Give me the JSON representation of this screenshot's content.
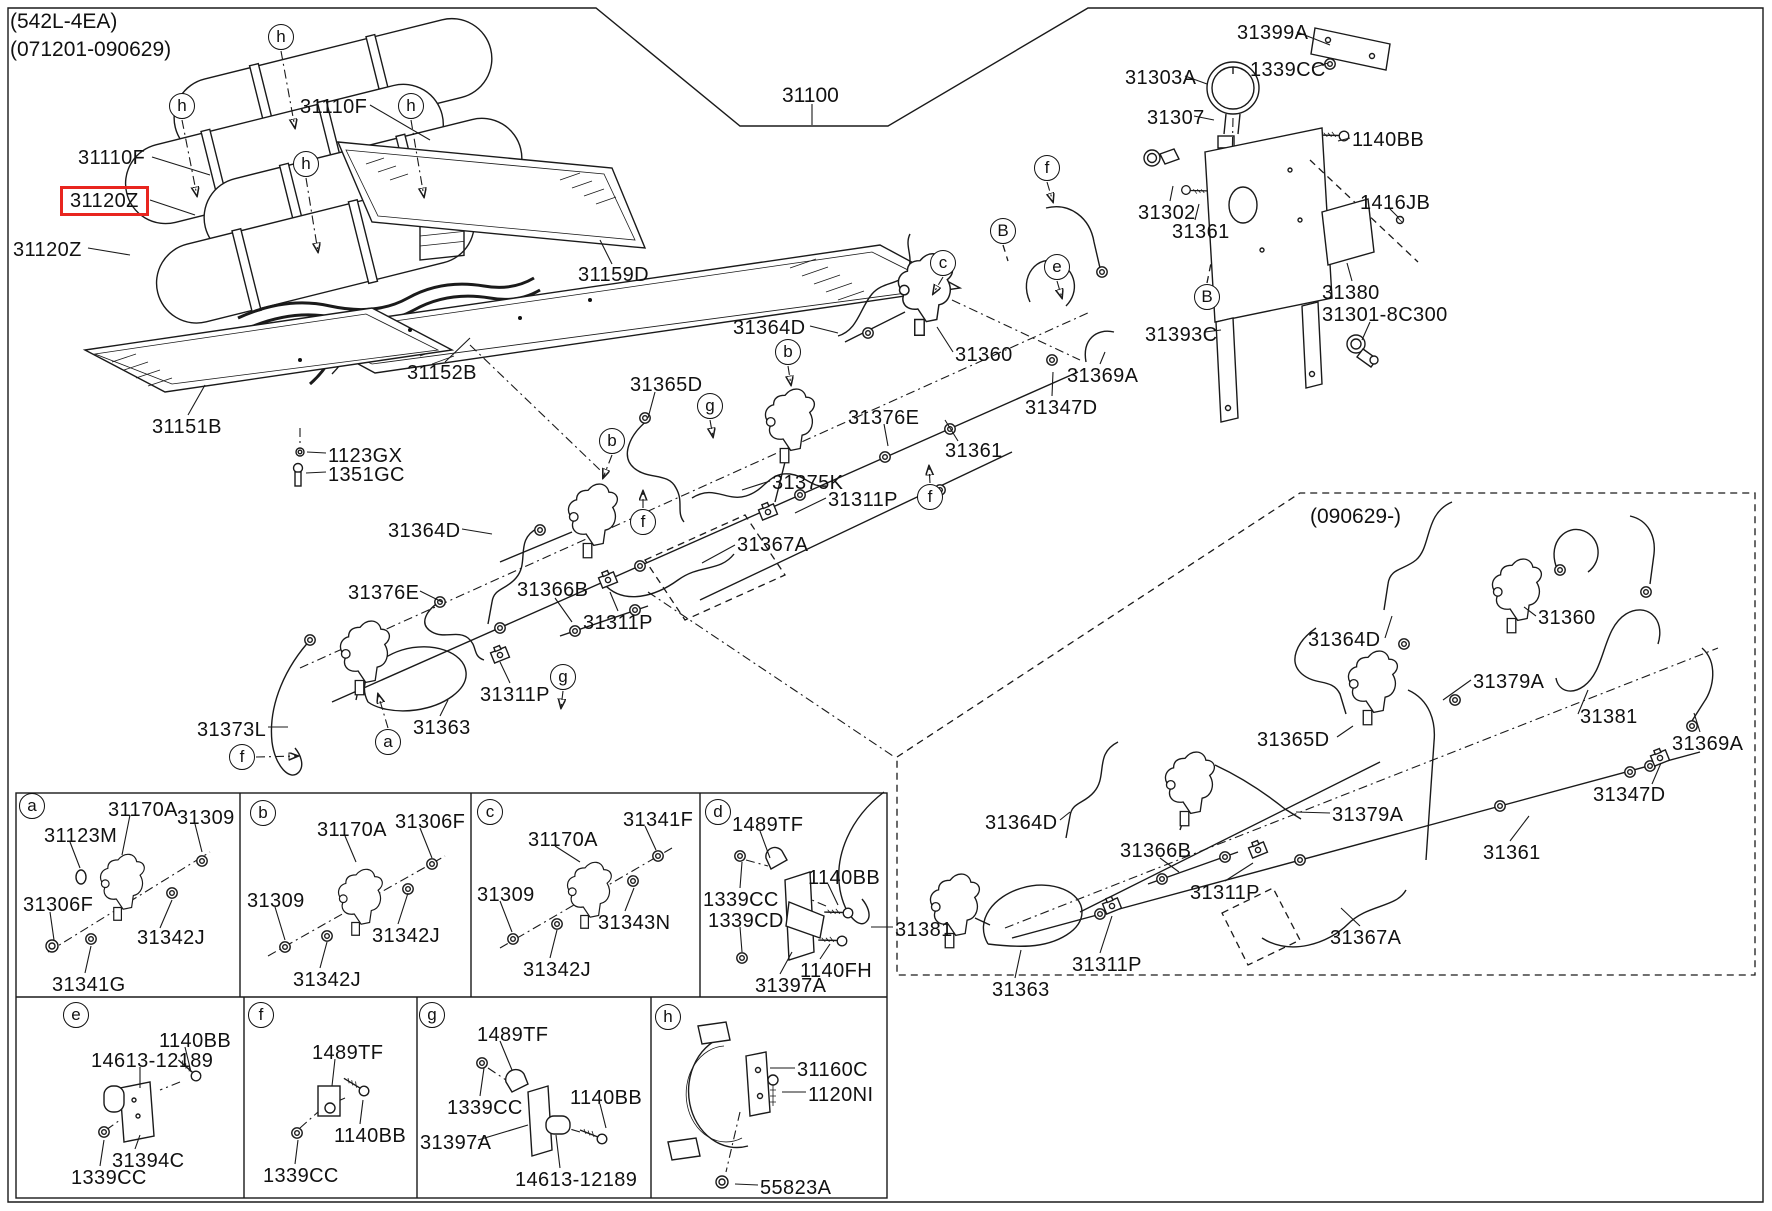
{
  "header": {
    "config": "(542L-4EA)",
    "range": "(071201-090629)"
  },
  "assembly_number": "31100",
  "dashed_section_title": "(090629-)",
  "highlight": {
    "part": "31120Z",
    "color": "#e8251f"
  },
  "part_labels": [
    {
      "t": "31110F",
      "x": 300,
      "y": 97
    },
    {
      "t": "31110F",
      "x": 78,
      "y": 148
    },
    {
      "t": "31120Z",
      "x": 70,
      "y": 192,
      "hl": true
    },
    {
      "t": "31120Z",
      "x": 13,
      "y": 240
    },
    {
      "t": "31159D",
      "x": 578,
      "y": 265
    },
    {
      "t": "31152B",
      "x": 407,
      "y": 363
    },
    {
      "t": "31151B",
      "x": 152,
      "y": 417
    },
    {
      "t": "1123GX",
      "x": 328,
      "y": 446
    },
    {
      "t": "1351GC",
      "x": 328,
      "y": 465
    },
    {
      "t": "31364D",
      "x": 733,
      "y": 318
    },
    {
      "t": "31365D",
      "x": 630,
      "y": 375
    },
    {
      "t": "31360",
      "x": 955,
      "y": 345
    },
    {
      "t": "31376E",
      "x": 848,
      "y": 408
    },
    {
      "t": "31369A",
      "x": 1067,
      "y": 366
    },
    {
      "t": "31347D",
      "x": 1025,
      "y": 398
    },
    {
      "t": "31361",
      "x": 945,
      "y": 441
    },
    {
      "t": "31375K",
      "x": 772,
      "y": 473
    },
    {
      "t": "31311P",
      "x": 828,
      "y": 490
    },
    {
      "t": "31367A",
      "x": 737,
      "y": 535
    },
    {
      "t": "31364D",
      "x": 388,
      "y": 521
    },
    {
      "t": "31376E",
      "x": 348,
      "y": 583
    },
    {
      "t": "31366B",
      "x": 517,
      "y": 580
    },
    {
      "t": "31311P",
      "x": 583,
      "y": 613
    },
    {
      "t": "31311P",
      "x": 480,
      "y": 685
    },
    {
      "t": "31373L",
      "x": 197,
      "y": 720
    },
    {
      "t": "31363",
      "x": 413,
      "y": 718
    },
    {
      "t": "31399A",
      "x": 1237,
      "y": 23
    },
    {
      "t": "1339CC",
      "x": 1250,
      "y": 60
    },
    {
      "t": "31303A",
      "x": 1125,
      "y": 68
    },
    {
      "t": "31307",
      "x": 1147,
      "y": 108
    },
    {
      "t": "1140BB",
      "x": 1352,
      "y": 130
    },
    {
      "t": "1416JB",
      "x": 1360,
      "y": 193
    },
    {
      "t": "31302",
      "x": 1138,
      "y": 203
    },
    {
      "t": "31361",
      "x": 1172,
      "y": 222
    },
    {
      "t": "31380",
      "x": 1322,
      "y": 283
    },
    {
      "t": "31301-8C300",
      "x": 1322,
      "y": 305
    },
    {
      "t": "31393C",
      "x": 1145,
      "y": 325
    },
    {
      "t": "31360",
      "x": 1538,
      "y": 608
    },
    {
      "t": "31364D",
      "x": 1308,
      "y": 630
    },
    {
      "t": "31379A",
      "x": 1473,
      "y": 672
    },
    {
      "t": "31381",
      "x": 1580,
      "y": 707
    },
    {
      "t": "31365D",
      "x": 1257,
      "y": 730
    },
    {
      "t": "31369A",
      "x": 1672,
      "y": 734
    },
    {
      "t": "31347D",
      "x": 1593,
      "y": 785
    },
    {
      "t": "31379A",
      "x": 1332,
      "y": 805
    },
    {
      "t": "31364D",
      "x": 985,
      "y": 813
    },
    {
      "t": "31366B",
      "x": 1120,
      "y": 841
    },
    {
      "t": "31361",
      "x": 1483,
      "y": 843
    },
    {
      "t": "31311P",
      "x": 1190,
      "y": 883
    },
    {
      "t": "31367A",
      "x": 1330,
      "y": 928
    },
    {
      "t": "31381",
      "x": 895,
      "y": 920
    },
    {
      "t": "31311P",
      "x": 1072,
      "y": 955
    },
    {
      "t": "31363",
      "x": 992,
      "y": 980
    },
    {
      "t": "31170A",
      "x": 108,
      "y": 800
    },
    {
      "t": "31309",
      "x": 177,
      "y": 808
    },
    {
      "t": "31123M",
      "x": 44,
      "y": 826
    },
    {
      "t": "31306F",
      "x": 23,
      "y": 895
    },
    {
      "t": "31342J",
      "x": 137,
      "y": 928
    },
    {
      "t": "31341G",
      "x": 52,
      "y": 975
    },
    {
      "t": "31170A",
      "x": 317,
      "y": 820
    },
    {
      "t": "31306F",
      "x": 395,
      "y": 812
    },
    {
      "t": "31309",
      "x": 247,
      "y": 891
    },
    {
      "t": "31342J",
      "x": 372,
      "y": 926
    },
    {
      "t": "31342J",
      "x": 293,
      "y": 970
    },
    {
      "t": "31170A",
      "x": 528,
      "y": 830
    },
    {
      "t": "31341F",
      "x": 623,
      "y": 810
    },
    {
      "t": "31309",
      "x": 477,
      "y": 885
    },
    {
      "t": "31343N",
      "x": 598,
      "y": 913
    },
    {
      "t": "31342J",
      "x": 523,
      "y": 960
    },
    {
      "t": "1489TF",
      "x": 732,
      "y": 815
    },
    {
      "t": "1140BB",
      "x": 808,
      "y": 868
    },
    {
      "t": "1339CC",
      "x": 703,
      "y": 890
    },
    {
      "t": "1339CD",
      "x": 708,
      "y": 911
    },
    {
      "t": "1140FH",
      "x": 800,
      "y": 961
    },
    {
      "t": "31397A",
      "x": 755,
      "y": 976
    },
    {
      "t": "1140BB",
      "x": 159,
      "y": 1031
    },
    {
      "t": "14613-12189",
      "x": 91,
      "y": 1051
    },
    {
      "t": "31394C",
      "x": 112,
      "y": 1151
    },
    {
      "t": "1339CC",
      "x": 71,
      "y": 1168
    },
    {
      "t": "1489TF",
      "x": 312,
      "y": 1043
    },
    {
      "t": "1140BB",
      "x": 334,
      "y": 1126
    },
    {
      "t": "1339CC",
      "x": 263,
      "y": 1166
    },
    {
      "t": "1489TF",
      "x": 477,
      "y": 1025
    },
    {
      "t": "1140BB",
      "x": 570,
      "y": 1088
    },
    {
      "t": "1339CC",
      "x": 447,
      "y": 1098
    },
    {
      "t": "31397A",
      "x": 420,
      "y": 1133
    },
    {
      "t": "14613-12189",
      "x": 515,
      "y": 1170
    },
    {
      "t": "31160C",
      "x": 797,
      "y": 1060
    },
    {
      "t": "1120NI",
      "x": 808,
      "y": 1085
    },
    {
      "t": "55823A",
      "x": 760,
      "y": 1178
    }
  ],
  "callouts": [
    {
      "l": "h",
      "x": 281,
      "y": 37
    },
    {
      "l": "h",
      "x": 182,
      "y": 106
    },
    {
      "l": "h",
      "x": 306,
      "y": 164
    },
    {
      "l": "h",
      "x": 411,
      "y": 106
    },
    {
      "l": "f",
      "x": 1047,
      "y": 168
    },
    {
      "l": "B",
      "x": 1003,
      "y": 231
    },
    {
      "l": "c",
      "x": 943,
      "y": 263
    },
    {
      "l": "e",
      "x": 1057,
      "y": 267
    },
    {
      "l": "B",
      "x": 1207,
      "y": 297
    },
    {
      "l": "b",
      "x": 788,
      "y": 352
    },
    {
      "l": "g",
      "x": 710,
      "y": 406
    },
    {
      "l": "b",
      "x": 612,
      "y": 441
    },
    {
      "l": "f",
      "x": 930,
      "y": 497
    },
    {
      "l": "f",
      "x": 643,
      "y": 522
    },
    {
      "l": "g",
      "x": 563,
      "y": 677
    },
    {
      "l": "a",
      "x": 388,
      "y": 742
    },
    {
      "l": "f",
      "x": 242,
      "y": 757
    }
  ],
  "panel_tags": [
    {
      "l": "a",
      "x": 32,
      "y": 806
    },
    {
      "l": "b",
      "x": 263,
      "y": 813
    },
    {
      "l": "c",
      "x": 490,
      "y": 812
    },
    {
      "l": "d",
      "x": 718,
      "y": 812
    },
    {
      "l": "e",
      "x": 76,
      "y": 1015
    },
    {
      "l": "f",
      "x": 261,
      "y": 1015
    },
    {
      "l": "g",
      "x": 432,
      "y": 1015
    },
    {
      "l": "h",
      "x": 668,
      "y": 1017
    }
  ]
}
